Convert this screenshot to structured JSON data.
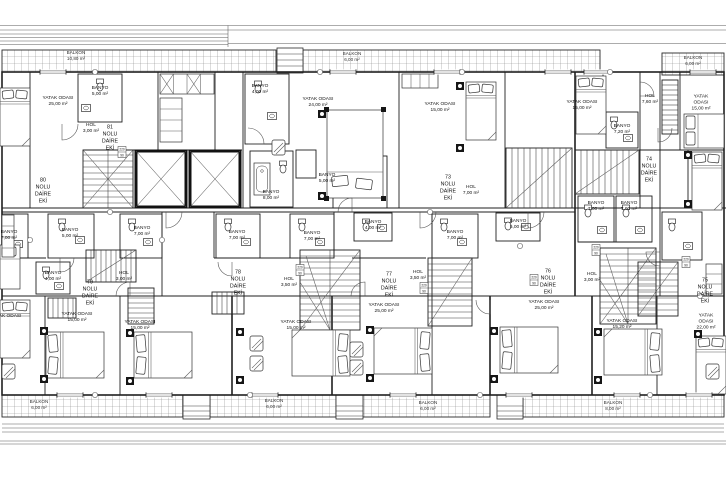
{
  "plan": {
    "balconies": {
      "top_left": "BALKON\n10,80 m²",
      "top_mid": "BALKON\n6,00 m²",
      "top_right": "BALKON\n6,00 m²",
      "bottom_left": "BALKON\n6,00 m²",
      "bottom_mid_1": "BALKON\n6,00 m²",
      "bottom_mid_2": "BALKON\n6,00 m²",
      "bottom_right": "BALKON\n8,00 m²"
    },
    "units": {
      "u73": "73\nNOLU\nDAİRE\nEKİ",
      "u74": "74\nNOLU\nDAİRE\nEKİ",
      "u75": "75\nNOLU\nDAİRE\nEKİ",
      "u76": "76\nNOLU\nDAİRE\nEKİ",
      "u77": "77\nNOLU\nDAİRE\nEKİ",
      "u78": "78\nNOLU\nDAİRE\nEKİ",
      "u79": "79\nNOLU\nDAİRE\nEKİ",
      "u80": "80\nNOLU\nDAİRE\nEKİ",
      "u81": "81\nNOLU\nDAİRE\nEKİ"
    },
    "rooms": {
      "yatak_15": "YATAK ODASI\n15,00 m²",
      "yatak_15_2": "YATAK ODASI\n15,20 m²",
      "yatak_22": "YATAK ODASI\n22,00 m²",
      "yatak_24": "YATAK ODASI\n24,00 m²",
      "yatak_25": "YATAK ODASI\n25,00 m²",
      "yatak_partial": "YATAK ODASI",
      "banyo_4": "BANYO\n4,00 m²",
      "banyo_5": "BANYO\n5,00 m²",
      "banyo_7": "BANYO\n7,00 m²",
      "banyo_7_2": "BANYO\n7,20 m²",
      "banyo_8": "BANYO\n8,00 m²",
      "hol_3": "HOL\n3,00 m²",
      "hol_3_5": "HOL\n3,50 m²",
      "hol_7": "HOL\n7,00 m²",
      "hol_7_6": "HOL\n7,60 m²"
    },
    "door_tag": {
      "width": "90",
      "height": "220"
    },
    "colors": {
      "line": "#1f1f1f",
      "fine": "#5a5a5a",
      "paper": "#ffffff"
    }
  }
}
